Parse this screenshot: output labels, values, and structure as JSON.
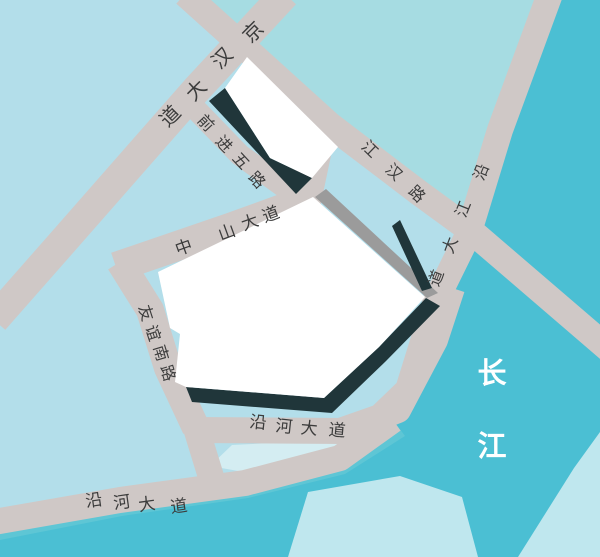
{
  "map": {
    "region_name": "Wuhan Jianghan riverside street map",
    "colors": {
      "land": "#b3deea",
      "land_cyan": "#a6dce2",
      "river": "#4bbfd3",
      "river_shore": "#5ec6d5",
      "river_light": "#bfe7ee",
      "gap_light": "#d4edf2",
      "road": "#cfc8c6",
      "block_white": "#ffffff",
      "shadow_dark": "#20363a",
      "shadow_gray": "#9b9b9b",
      "label": "#3c3c3c",
      "river_label": "#ffffff"
    },
    "roads": [
      {
        "id": "jinghan-avenue",
        "name": "京汉大道",
        "size": 20,
        "chars": [
          {
            "ch": "京",
            "x": 253,
            "y": 32,
            "rot": -45
          },
          {
            "ch": "汉",
            "x": 222,
            "y": 58,
            "rot": -45
          },
          {
            "ch": "大",
            "x": 196,
            "y": 90,
            "rot": -45
          },
          {
            "ch": "道",
            "x": 170,
            "y": 116,
            "rot": -45
          }
        ]
      },
      {
        "id": "qianjin-5th-road",
        "name": "前进五路",
        "size": 16,
        "chars": [
          {
            "ch": "前",
            "x": 206,
            "y": 123,
            "rot": 47
          },
          {
            "ch": "进",
            "x": 224,
            "y": 144,
            "rot": 47
          },
          {
            "ch": "五",
            "x": 241,
            "y": 161,
            "rot": 47
          },
          {
            "ch": "路",
            "x": 257,
            "y": 180,
            "rot": 47
          }
        ]
      },
      {
        "id": "jianghan-road",
        "name": "江汉路",
        "size": 16,
        "chars": [
          {
            "ch": "江",
            "x": 370,
            "y": 149,
            "rot": 44
          },
          {
            "ch": "汉",
            "x": 394,
            "y": 172,
            "rot": 44
          },
          {
            "ch": "路",
            "x": 417,
            "y": 194,
            "rot": 44
          }
        ]
      },
      {
        "id": "yanjiang-avenue",
        "name": "沿江大道",
        "size": 16,
        "chars": [
          {
            "ch": "沿",
            "x": 481,
            "y": 172,
            "rot": -68
          },
          {
            "ch": "江",
            "x": 463,
            "y": 209,
            "rot": -68
          },
          {
            "ch": "大",
            "x": 450,
            "y": 245,
            "rot": -69
          },
          {
            "ch": "道",
            "x": 436,
            "y": 278,
            "rot": -69
          }
        ]
      },
      {
        "id": "zhongshan-avenue",
        "name": "中山大道",
        "size": 17,
        "chars": [
          {
            "ch": "中",
            "x": 184,
            "y": 248,
            "rot": -20
          },
          {
            "ch": "山",
            "x": 227,
            "y": 233,
            "rot": -20
          },
          {
            "ch": "大",
            "x": 250,
            "y": 223,
            "rot": -20
          },
          {
            "ch": "道",
            "x": 271,
            "y": 215,
            "rot": -20
          }
        ]
      },
      {
        "id": "youyi-south-road",
        "name": "友谊南路",
        "size": 16,
        "chars": [
          {
            "ch": "友",
            "x": 146,
            "y": 313,
            "rot": 72
          },
          {
            "ch": "谊",
            "x": 153,
            "y": 333,
            "rot": 72
          },
          {
            "ch": "南",
            "x": 161,
            "y": 353,
            "rot": 73
          },
          {
            "ch": "路",
            "x": 168,
            "y": 373,
            "rot": 73
          }
        ]
      },
      {
        "id": "yanhe-avenue-upper",
        "name": "沿河大道",
        "size": 17,
        "chars": [
          {
            "ch": "沿",
            "x": 258,
            "y": 423,
            "rot": 6
          },
          {
            "ch": "河",
            "x": 284,
            "y": 427,
            "rot": 6
          },
          {
            "ch": "大",
            "x": 309,
            "y": 429,
            "rot": 5
          },
          {
            "ch": "道",
            "x": 337,
            "y": 431,
            "rot": 5
          }
        ]
      },
      {
        "id": "yanhe-avenue-lower",
        "name": "沿河大道",
        "size": 17,
        "chars": [
          {
            "ch": "沿",
            "x": 94,
            "y": 501,
            "rot": -8
          },
          {
            "ch": "河",
            "x": 122,
            "y": 503,
            "rot": -8
          },
          {
            "ch": "大",
            "x": 147,
            "y": 505,
            "rot": -8
          },
          {
            "ch": "道",
            "x": 179,
            "y": 507,
            "rot": -8
          }
        ]
      }
    ],
    "river": {
      "id": "changjiang",
      "name": "长江",
      "size": 29,
      "chars": [
        {
          "ch": "长",
          "x": 492,
          "y": 373
        },
        {
          "ch": "江",
          "x": 492,
          "y": 446
        }
      ]
    }
  }
}
